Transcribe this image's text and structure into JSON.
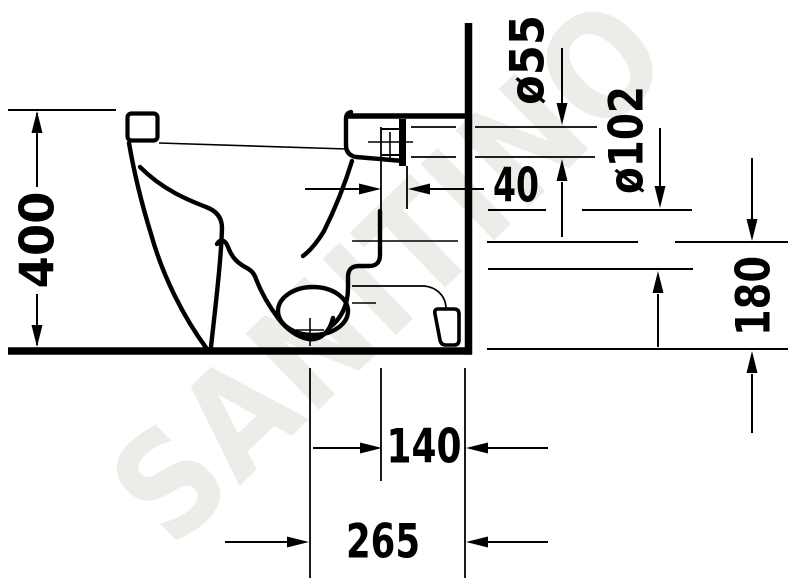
{
  "watermark": {
    "text": "SANITINO",
    "color": "#e9e6e1"
  },
  "dimensions": {
    "overall_height": "400",
    "flush_pipe_diameter": "ø55",
    "outlet_hole_diameter": "ø102",
    "spigot_depth": "40",
    "outlet_center_height": "180",
    "outlet_offset_from_wall": "140",
    "vertical_outlet_distance": "265"
  },
  "colors": {
    "line": "#000000",
    "background": "#ffffff"
  }
}
